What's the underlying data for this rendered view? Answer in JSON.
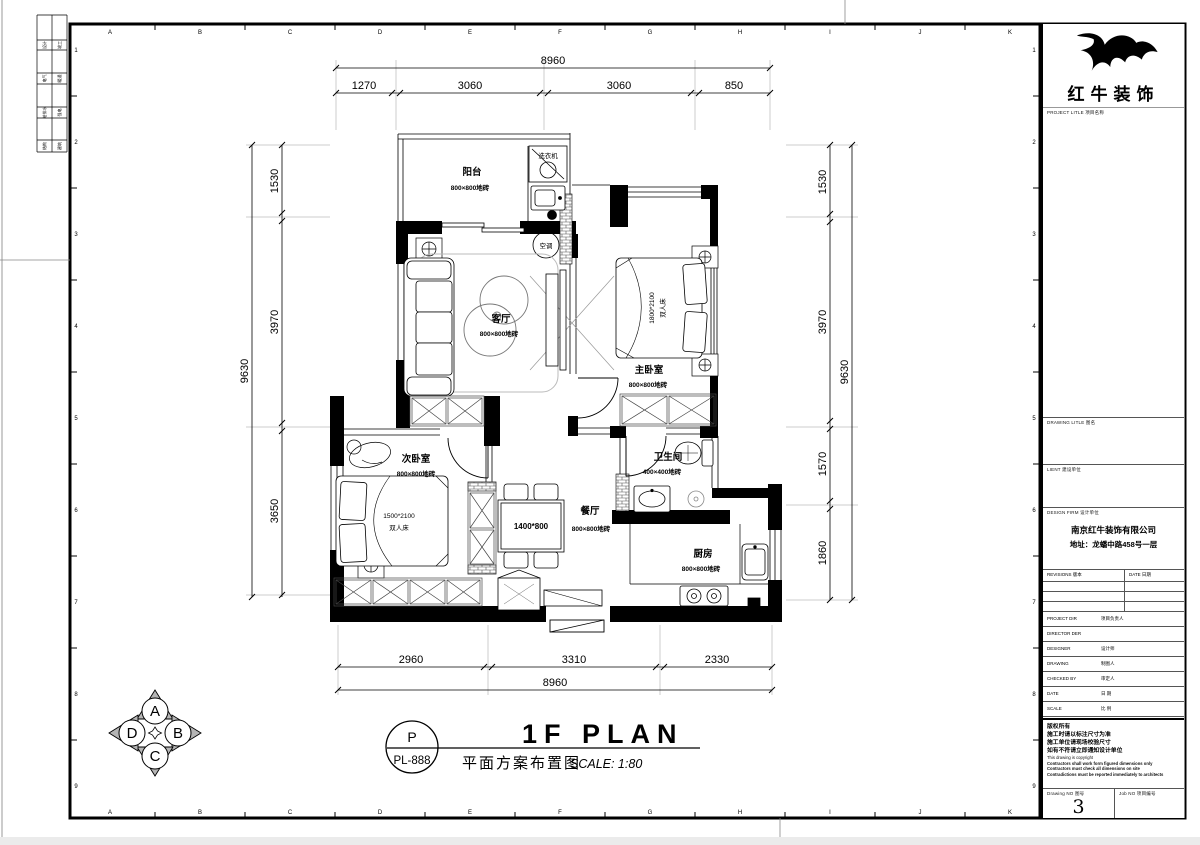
{
  "grid": {
    "letters": [
      "A",
      "B",
      "C",
      "D",
      "E",
      "F",
      "G",
      "H",
      "I",
      "J",
      "K"
    ],
    "numbers": [
      "1",
      "2",
      "3",
      "4",
      "5",
      "6",
      "7",
      "8",
      "9"
    ]
  },
  "edge_table": {
    "rows": [
      [
        "设计",
        "竣工"
      ],
      [
        "电气",
        "暖通"
      ],
      [
        "给排水",
        "强电"
      ],
      [
        "结构",
        "建筑"
      ]
    ]
  },
  "plan": {
    "rooms": [
      {
        "name": "阳台",
        "tile": "800×800地砖"
      },
      {
        "name": "客厅",
        "tile": "800×800地砖"
      },
      {
        "name": "主卧室",
        "tile": "800×800地砖"
      },
      {
        "name": "次卧室",
        "tile": "800×800地砖"
      },
      {
        "name": "卫生间",
        "tile": "400×400地砖"
      },
      {
        "name": "餐厅",
        "tile": "800×800地砖"
      },
      {
        "name": "厨房",
        "tile": "800×800地砖"
      }
    ],
    "annotations": {
      "washer": "洗衣机",
      "ac": "空调",
      "master_bed_size": "1800*2100",
      "master_bed_name": "双人床",
      "second_bed_size": "1500*2100",
      "second_bed_name": "双人床",
      "dining_table_size": "1400*800"
    }
  },
  "dims": {
    "top": {
      "total": "8960",
      "segments": [
        "1270",
        "3060",
        "3060",
        "850"
      ]
    },
    "bottom": {
      "total": "8960",
      "segments": [
        "2960",
        "3310",
        "2330"
      ]
    },
    "left": {
      "total": "9630",
      "segments": [
        "1530",
        "3970",
        "3650"
      ]
    },
    "right": {
      "total": "9630",
      "segments": [
        "1530",
        "3970",
        "1570",
        "1860"
      ]
    }
  },
  "compass": {
    "north": "A",
    "east": "B",
    "south": "C",
    "west": "D"
  },
  "footer": {
    "stamp_top": "P",
    "stamp_no": "PL-888",
    "title_en": "1F PLAN",
    "title_cn": "平面方案布置图",
    "scale": "SCALE: 1:80"
  },
  "titleblock": {
    "logo_text": "红牛装饰",
    "project_label": "PROJECT LITLE  项目名称",
    "drawing_label": "DRAWING LITLE  图名",
    "client_label": "LIENT  建设单位",
    "design_firm_label": "DESIGN FIRM  设计单位",
    "firm_name": "南京红牛装饰有限公司",
    "firm_address": "地址：龙蟠中路458号一层",
    "revisions_label": "REVISIONS  版本",
    "revisions_date_label": "DATE  日期",
    "fields": [
      {
        "en": "PROJECT DIR",
        "cn": "项目负责人"
      },
      {
        "en": "DIRECTOR DER",
        "cn": ""
      },
      {
        "en": "DESIGNER",
        "cn": "设计师"
      },
      {
        "en": "DRAWING",
        "cn": "制图人"
      },
      {
        "en": "CHECKED BY",
        "cn": "审定人"
      },
      {
        "en": "DATE",
        "cn": "日  期"
      },
      {
        "en": "SCALE",
        "cn": "比  例"
      }
    ],
    "notes_cn": [
      "版权所有",
      "施工时请以标注尺寸为准",
      "施工单位请现场校验尺寸",
      "如有不符请立即通知设计单位"
    ],
    "notes_en": [
      "This drawing is copyright",
      "Contractors shall work form figured dimensions only",
      "Contractors must check all dimensions on site",
      "Contradictions must be reported immediately to architects"
    ],
    "drawing_no_label": "Drawing NO  图号",
    "drawing_no": "3",
    "job_no_label": "Job NO  项目编号"
  }
}
